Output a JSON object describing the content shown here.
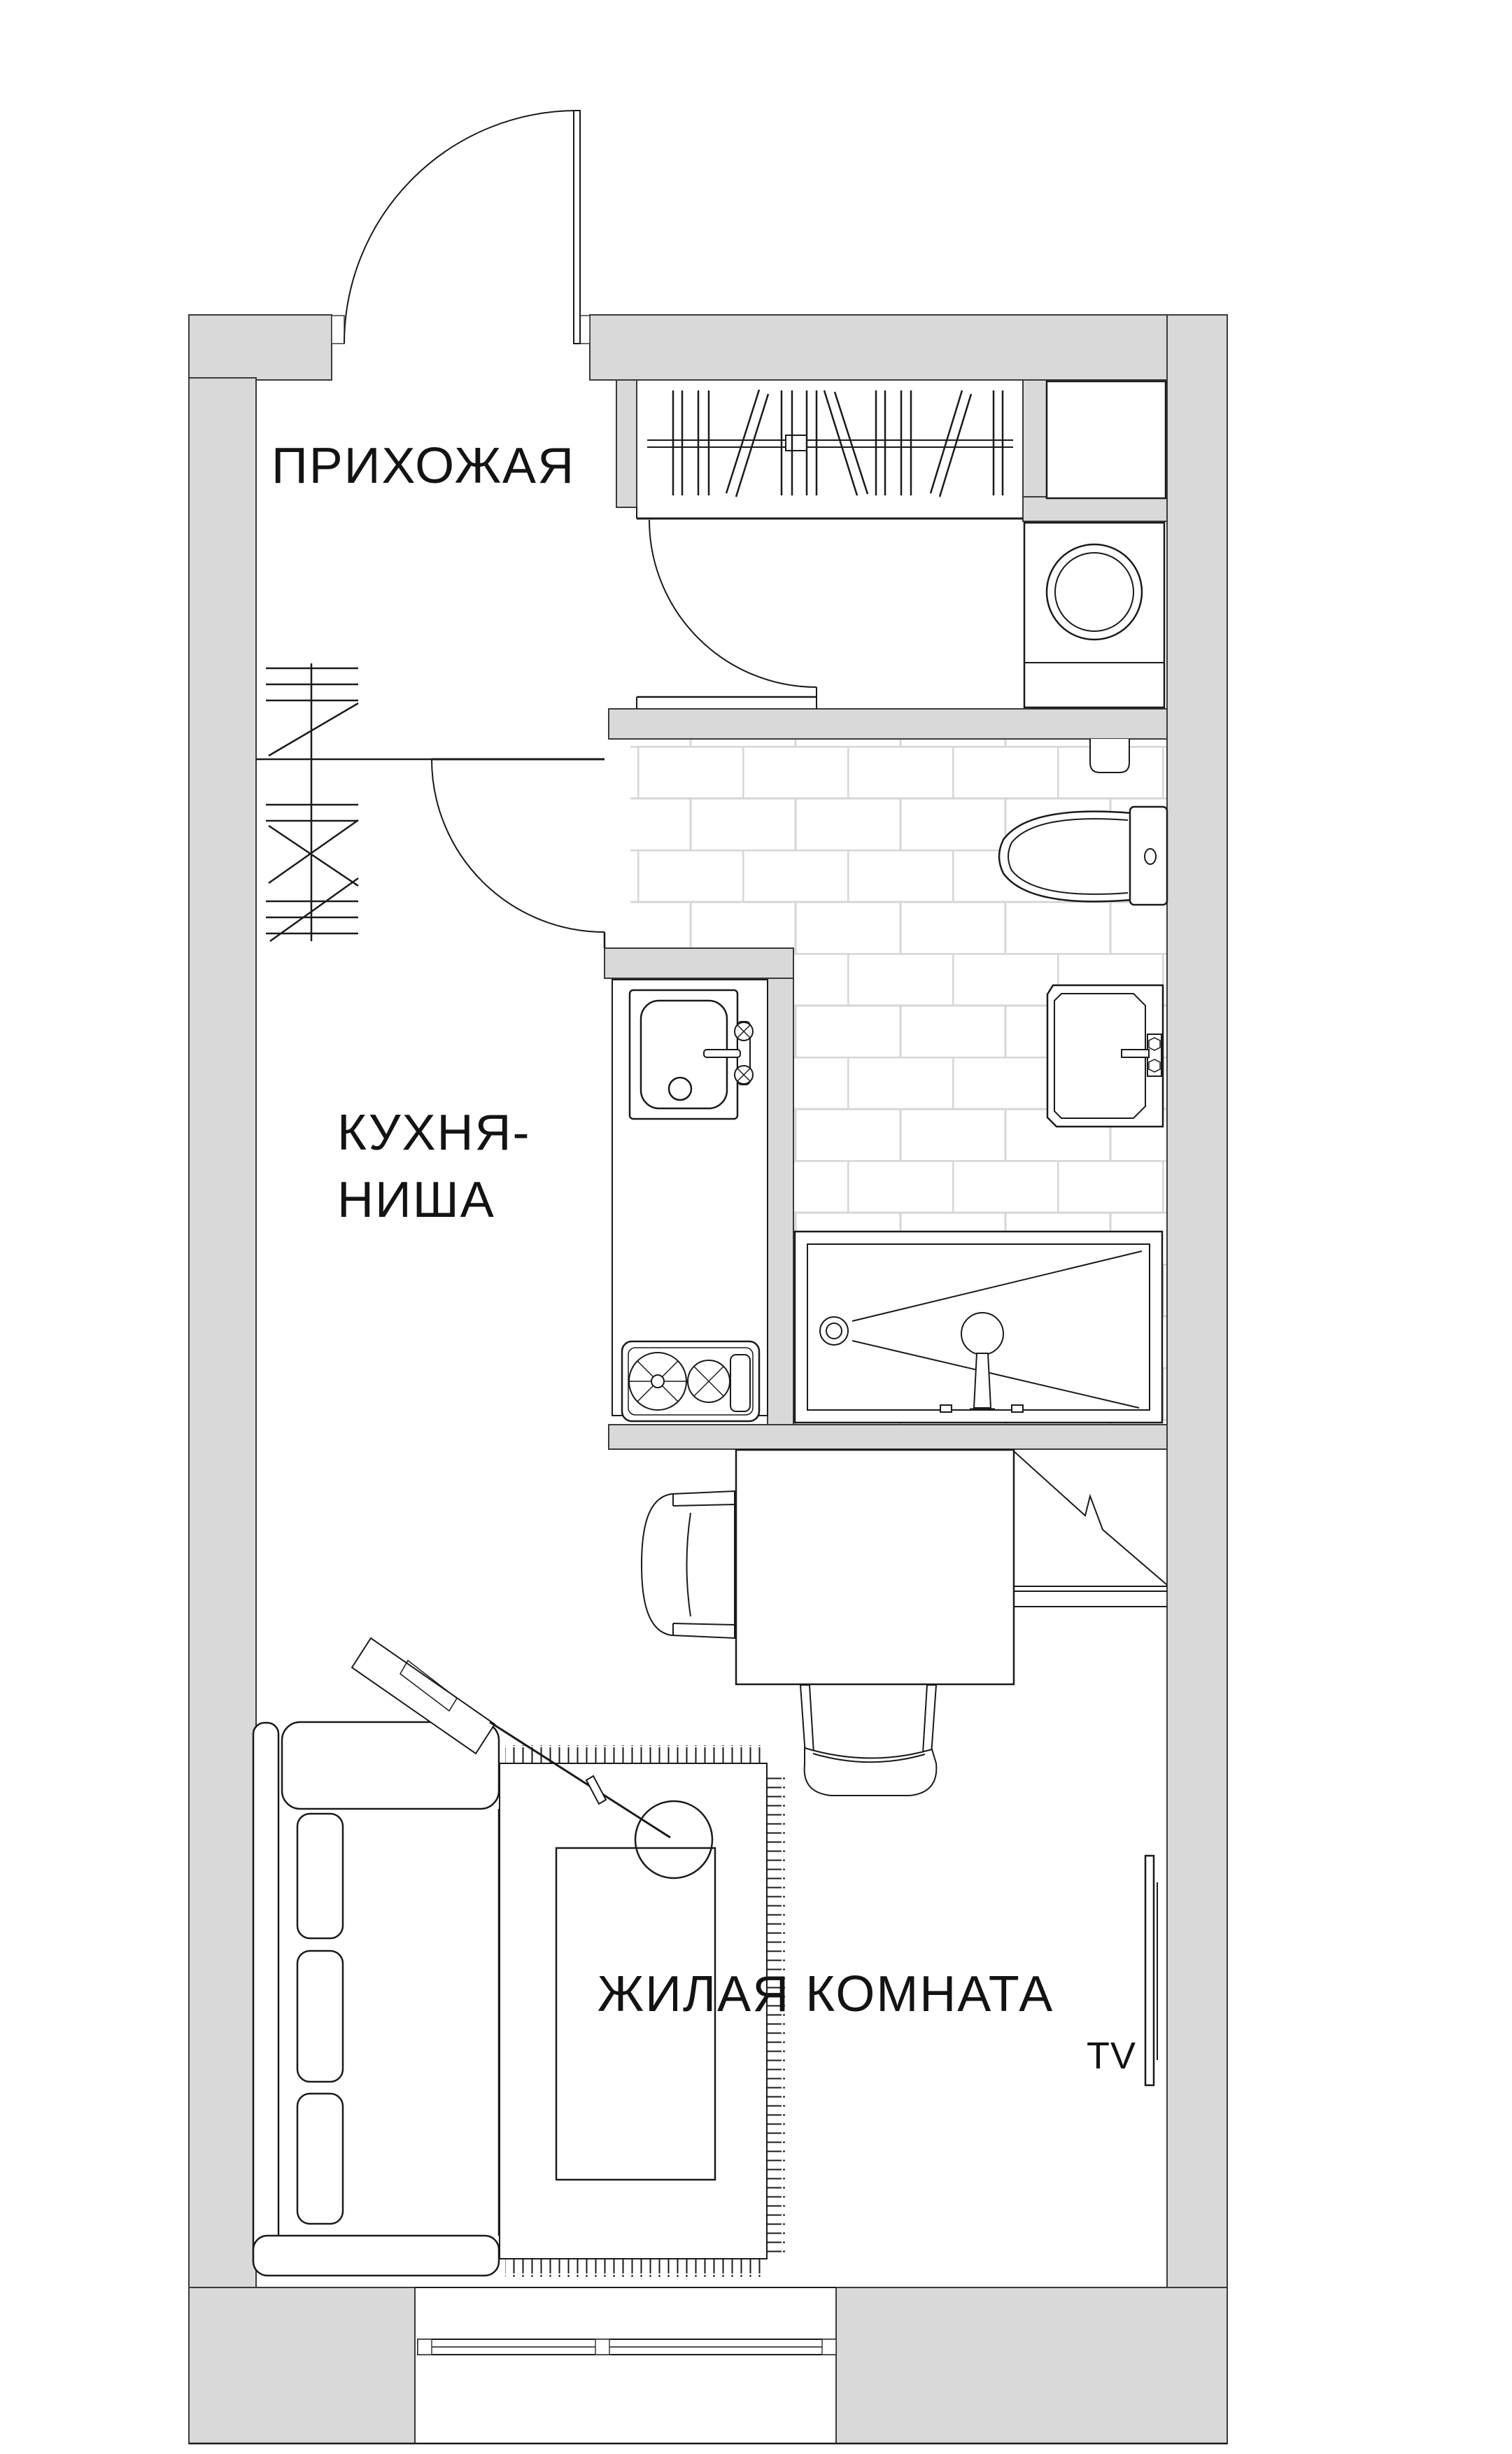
{
  "document": {
    "type": "apartment-floor-plan",
    "language": "ru"
  },
  "colors": {
    "background": "#ffffff",
    "wall_fill": "#d9d9d9",
    "line": "#1a1a1a",
    "tile_grout": "#d6d6d6",
    "text": "#131313"
  },
  "rooms": [
    {
      "id": "hallway",
      "label": "ПРИХОЖАЯ"
    },
    {
      "id": "kitchen-niche",
      "label": "КУХНЯ-НИША",
      "label_line1": "КУХНЯ-",
      "label_line2": "НИША"
    },
    {
      "id": "living-room",
      "label": "ЖИЛАЯ КОМНАТА"
    },
    {
      "id": "bathroom",
      "label": ""
    }
  ],
  "annotations": {
    "tv_label": "TV"
  },
  "fixtures": [
    "entrance-door",
    "kitchen-door",
    "bathroom-door",
    "wardrobe-with-clothes",
    "coat-rack",
    "storage-closet",
    "washing-machine",
    "toilet",
    "toilet-paper-holder",
    "wall-sink",
    "shower-bathtub",
    "kitchen-counter",
    "kitchen-sink",
    "stove",
    "dining-table",
    "chair-left",
    "chair-bottom",
    "corner-unit",
    "wall-shelf",
    "sofa",
    "rug",
    "coffee-table",
    "floor-lamp",
    "tv-panel",
    "window"
  ]
}
